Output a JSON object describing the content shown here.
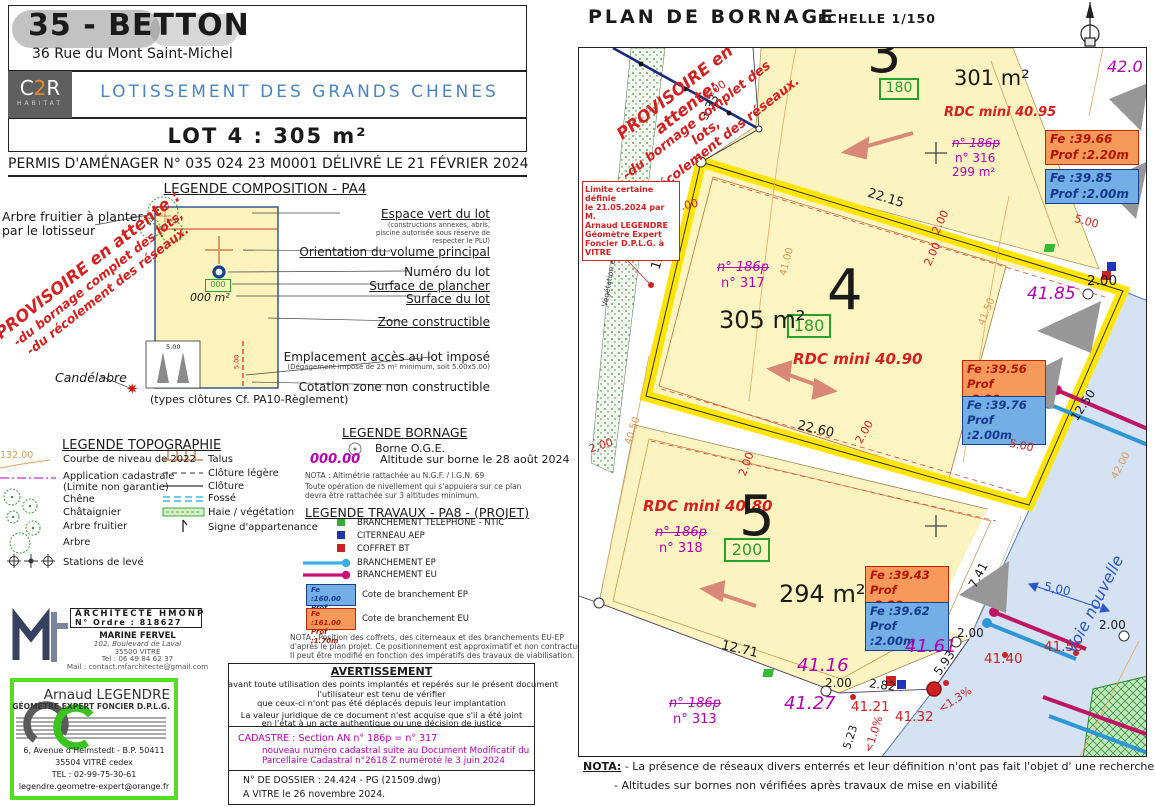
{
  "header": {
    "region_city": "35 - BETTON",
    "address": "36 Rue du Mont Saint-Michel",
    "logo": {
      "p1": "C",
      "p2": "2",
      "p3": "R",
      "sub": "HABITAT"
    },
    "subdivision": "LOTISSEMENT  DES  GRANDS  CHENES",
    "lot_title": "LOT  4  :  305 m²",
    "permit": "PERMIS D'AMÉNAGER N° 035 024 23 M0001 DÉLIVRÉ LE 21 FÉVRIER 2024"
  },
  "legend_composition": {
    "title": "LEGENDE COMPOSITION - PA4",
    "tree_l1": "Arbre fruitier à planter",
    "tree_l2": "par le lotisseur",
    "candelabre": "Candélabre",
    "provisoire": [
      "PROVISOIRE en attente :",
      "-du bornage complet des lots,",
      "-du récolement des réseaux."
    ],
    "right": [
      "Espace vert du lot",
      "Orientation du volume principal",
      "Numéro du lot",
      "Surface de plancher",
      "Surface du lot",
      "Zone constructible",
      "Emplacement accès au lot imposé",
      "Cotation zone non constructible"
    ],
    "note_espace": [
      "(constructions annexes, abris,",
      "piscine autorisée sous réserve de",
      "respecter le PLU)"
    ],
    "note_acces": "(Dégagement imposé de 25 m² minimum, soit 5.00x5.00)",
    "sample_sdp": "000",
    "sample_surface": "000 m²",
    "dim_a": "5.00",
    "dim_b": "5.00",
    "types": "(types clôtures Cf. PA10-Règlement)"
  },
  "legend_topo": {
    "title": "LEGENDE TOPOGRAPHIE",
    "contour_sample": "132.00",
    "left": [
      "Courbe de niveau de 2022",
      "Application cadastrale",
      "(Limite non garantie)",
      "Chêne",
      "Châtaignier",
      "Arbre fruitier",
      "Arbre",
      "Stations de levé"
    ],
    "right": [
      "Talus",
      "Clôture légère",
      "Clôture",
      "Fossé",
      "Haie / végétation",
      "Signe d'appartenance"
    ]
  },
  "legend_bornage": {
    "title": "LEGENDE BORNAGE",
    "borne": "Borne O.G.E.",
    "alt_sample": "000.00",
    "alt_label": "Altitude sur borne le 28 août 2024",
    "nota1": "NOTA : Altimétrie rattachée au N.G.F. / I.G.N. 69",
    "nota2": "Toute opération de nivellement qui s'appuiera sur ce plan",
    "nota3": "devra être rattachée sur 3 altitudes minimum."
  },
  "legend_travaux": {
    "title": "LEGENDE TRAVAUX - PA8 - (PROJET)",
    "items": [
      "BRANCHEMENT  TELEPHONE - NTIC",
      "CITERNEAU AEP",
      "COFFRET BT",
      "BRANCHEMENT  EP",
      "BRANCHEMENT  EU"
    ],
    "fe_ep": {
      "l1": "Fe :160.00",
      "l2": "Prof :1.50m"
    },
    "fe_ep_label": "Cote de branchement EP",
    "fe_eu": {
      "l1": "Fe :161.00",
      "l2": "Prof :1.70m"
    },
    "fe_eu_label": "Cote de branchement EU",
    "nota": [
      "NOTA : Position des coffrets, des citerneaux et des branchements EU-EP",
      "d'après le plan projet. Ce positionnement est approximatif et non contractuel.",
      "Il peut être modifié en fonction des impératifs des travaux de viabilisation."
    ]
  },
  "architect": {
    "t1": "ARCHITECTE HMONP",
    "t2": "N° Ordre : 818627",
    "name": "MARINE FERVEL",
    "a1": "102, Boulevard de Laval",
    "a2": "35500 VITRÉ",
    "tel": "Tel : 06 49 84 62 37",
    "mail": "Mail : contact.mfarchitecte@gmail.com"
  },
  "surveyor": {
    "name": "Arnaud LEGENDRE",
    "title": "GÉOMÈTRE EXPERT FONCIER D.P.L.G.",
    "a1": "6, Avenue d'Helmstedt - B.P. 50411",
    "a2": "35504 VITRÉ cedex",
    "tel": "TEL : 02-99-75-30-61",
    "mail": "legendre.geometre-expert@orange.fr"
  },
  "warning": {
    "title": "AVERTISSEMENT",
    "lines": [
      "avant toute utilisation des points implantés et repérés sur le présent document",
      "l'utilisateur est tenu de vérifier",
      "que ceux-ci n'ont pas été déplacés depuis leur implantation",
      "La valeur juridique de ce document n'est acquise que s'il a été joint",
      "en l'état à un acte authentique ou une décision de justice"
    ]
  },
  "cadastre": {
    "l1": "CADASTRE : Section AN n° 186p = n° 317",
    "l2": "nouveau numéro cadastral suite au Document Modificatif du",
    "l3": "Parcellaire Cadastral n°2618 Z numéroté le 3 juin 2024"
  },
  "dossier": {
    "l1": "N°  DE  DOSSIER  : 24.424 - PG   (21509.dwg)",
    "l2": "A  VITRE  le  26 novembre 2024."
  },
  "plan": {
    "title": "PLAN DE BORNAGE",
    "scale": "ECHELLE 1/150",
    "provisoire": [
      "PROVISOIRE en attente:",
      "-du bornage complet des lots,",
      "-du récolement des réseaux."
    ],
    "limite": [
      "Limite certaine définie",
      "le 21.05.2024 par M.",
      "Arnaud LEGENDRE",
      "Géomètre Expert",
      "Foncier D.P.L.G. à",
      "VITRE"
    ],
    "lots": {
      "lot3": {
        "num": "3",
        "area": "301 m²",
        "sdp": "180",
        "rdc": "RDC mini 40.95",
        "old": "n° 186p",
        "new": "n° 316",
        "new_area": "299 m²"
      },
      "lot4": {
        "num": "4",
        "area": "305 m²",
        "sdp": "180",
        "rdc": "RDC mini 40.90",
        "old": "n° 186p",
        "new": "n° 317"
      },
      "lot5": {
        "num": "5",
        "area": "294 m²",
        "sdp": "200",
        "rdc": "RDC mini 40.80",
        "old": "n° 186p",
        "new": "n° 318"
      },
      "p313": {
        "old": "n° 186p",
        "new": "n° 313"
      }
    },
    "fe": {
      "b1o1": "Fe :39.66",
      "b1o2": "Prof :2.20m",
      "b1b1": "Fe :39.85",
      "b1b2": "Prof :2.00m",
      "b2o1": "Fe :39.56",
      "b2o2": "Prof :2.20m",
      "b2b1": "Fe :39.76",
      "b2b2": "Prof :2.00m",
      "b3o1": "Fe :39.43",
      "b3o2": "Prof :2.20m",
      "b3b1": "Fe :39.62",
      "b3b2": "Prof :2.00m"
    },
    "dims": {
      "d333": "3,33",
      "d2215": "22.15",
      "d1251": "12.51",
      "d2260": "22.60",
      "d1271": "12.71",
      "d741": "7.41",
      "d1250": "12.50",
      "d282": "2.82",
      "d593": "5.93",
      "d523": "5.23",
      "d200": "2.00",
      "d500": "5.00",
      "d500c": "5,00"
    },
    "slopes": {
      "s10": "<1.0%",
      "s13": "<1.3%"
    },
    "alts": {
      "a420": "42.0",
      "a4185": "41.85",
      "a4116": "41.16",
      "a4127": "41.27",
      "a4161": "41.61"
    },
    "alts_red": {
      "a4121": "41.21",
      "a4132": "41.32",
      "a4140": "41.40",
      "a4156": "41.56"
    },
    "contours": {
      "c4050": "40.50",
      "c4100": "41.00",
      "c4150": "41.50",
      "c4200": "42.00"
    },
    "road": "Voie  nouvelle",
    "veg": "Végétation existante",
    "nota_title": "NOTA:",
    "nota1": "- La présence de réseaux divers enterrés et leur définition n'ont pas fait l'objet d' une recherche exhaustive.",
    "nota2": "- Altitudes sur bornes non vérifiées après travaux de mise en viabilité"
  }
}
